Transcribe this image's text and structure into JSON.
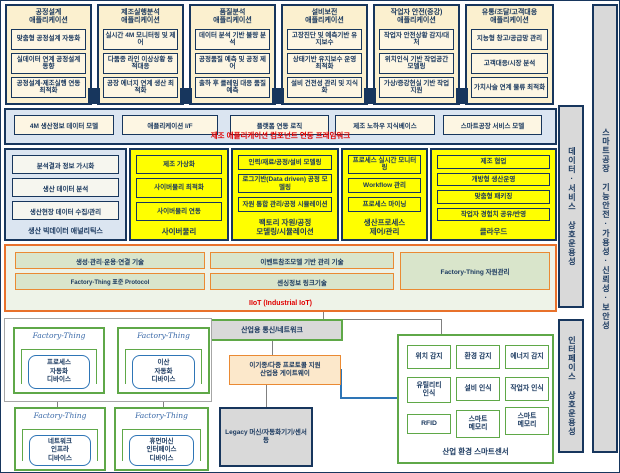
{
  "colors": {
    "navy": "#17365d",
    "yellow": "#ffff00",
    "orange": "#e8712b",
    "green": "#5fa848",
    "red": "#e00000",
    "blue": "#2e75b6",
    "cream": "#fbf0cf",
    "band_blue": "#dbe5f1"
  },
  "app_columns": [
    {
      "title": "공정설계\n애플리케이션",
      "items": [
        "맞춤형 공정설계 자동화",
        "실데이터 연계 공정설계 동향",
        "공정설계-제조실행 연동 최적화"
      ]
    },
    {
      "title": "제조실행분석\n애플리케이션",
      "items": [
        "실시간 4M 모니터링 및 제어",
        "다품종 라인 이상상황 동적대응",
        "공장 에너지 연계 생산 최적화"
      ]
    },
    {
      "title": "품질분석\n애플리케이션",
      "items": [
        "데이터 분석 기반 불량 분석",
        "공정품질 예측 및 공정 제어",
        "출하 후 클레임 대응 품질예측"
      ]
    },
    {
      "title": "설비보전\n애플리케이션",
      "items": [
        "고장진단 및 예측기반 유지보수",
        "상태기반 유지보수 운영 최적화",
        "설비 건전성 관리 및 지식화"
      ]
    },
    {
      "title": "작업자 안전(증강)\n애플리케이션",
      "items": [
        "작업자 안전상황 감지/대처",
        "위치인식 기반 작업공간 모델링",
        "가상/증강현실 기반 작업지원"
      ]
    },
    {
      "title": "유통/조달/고객대응\n애플리케이션",
      "items": [
        "지능형 창고/공급망 관리",
        "고객대응/시장 분석",
        "가치사슬 연계 물류 최적화"
      ]
    }
  ],
  "framework_band": {
    "boxes": [
      "4M 생산정보 데이터 모델",
      "애플리케이션 I/F",
      "플랫폼 연동 로직",
      "제조 노하우 지식베이스",
      "스마트공장 서비스 모델"
    ],
    "label": "제조 애플리케이션 컴포넌트 연동 프레임워크"
  },
  "analytics_panel": {
    "items": [
      "분석결과 정보 가시화",
      "생산 데이터 분석",
      "생산현장 데이터 수집/관리"
    ],
    "label": "생산 빅데이터 애널리틱스"
  },
  "yellow_columns": [
    {
      "label": "사이버물리",
      "items": [
        "제조 가상화",
        "사이버물리 최적화",
        "사이버물리 연동"
      ]
    },
    {
      "label": "팩토리 자원/공정\n모델링/시뮬레이션",
      "items": [
        "인력/재료/공정/설비 모델링",
        "로그기반(Data driven) 공정 모델링",
        "자원 통합 관리/공정 시뮬레이션"
      ]
    },
    {
      "label": "생산프로세스\n제어/관리",
      "items": [
        "프로세스 실시간 모니터링",
        "Workflow 관리",
        "프로세스 마이닝"
      ]
    },
    {
      "label": "클라우드",
      "items": [
        "제조 협업",
        "개방형 생산운영",
        "맞춤형 패키징",
        "작업자 경험치 공유/반영"
      ]
    }
  ],
  "iiot_band": {
    "left_boxes": [
      "생성·관리·운용·연결 기술",
      "Factory-Thing 표준 Protocol"
    ],
    "mid_boxes": [
      "이벤트참조모델 기반 관리 기술",
      "센싱정보 링크기술"
    ],
    "right_box": "Factory-Thing 자원관리",
    "label": "IIoT (Industrial IoT)"
  },
  "bottom": {
    "network_box": "산업용 통신/네트워크",
    "gateway": "이기종/다중 프로토콜 지원\n산업용 게이트웨이",
    "legacy": "Legacy 머신/자동화기기/센서 등",
    "factory_things": [
      {
        "label": "Factory-Thing",
        "device": "프로세스\n자동화\n디바이스"
      },
      {
        "label": "Factory-Thing",
        "device": "이산\n자동화\n디바이스"
      },
      {
        "label": "Factory-Thing",
        "device": "네트워크\n인프라\n디바이스"
      },
      {
        "label": "Factory-Thing",
        "device": "휴먼머신\n인터페이스\n디바이스"
      }
    ],
    "sensor_panel": {
      "cells": [
        "위치 감지",
        "환경 감지",
        "에너지 감지",
        "유틸리티\n인식",
        "설비 인식",
        "작업자 인식",
        "RFID",
        "스마트\n메모리",
        "스마트\n메모리"
      ],
      "label": "산업 환경 스마트센서"
    }
  },
  "side_bars": {
    "data_service": "데이터·서비스 상호운용성",
    "interface": "인터페이스 상호운용성",
    "safety": "스마트공장 기능안전·가용성·신뢰성·보안성"
  }
}
